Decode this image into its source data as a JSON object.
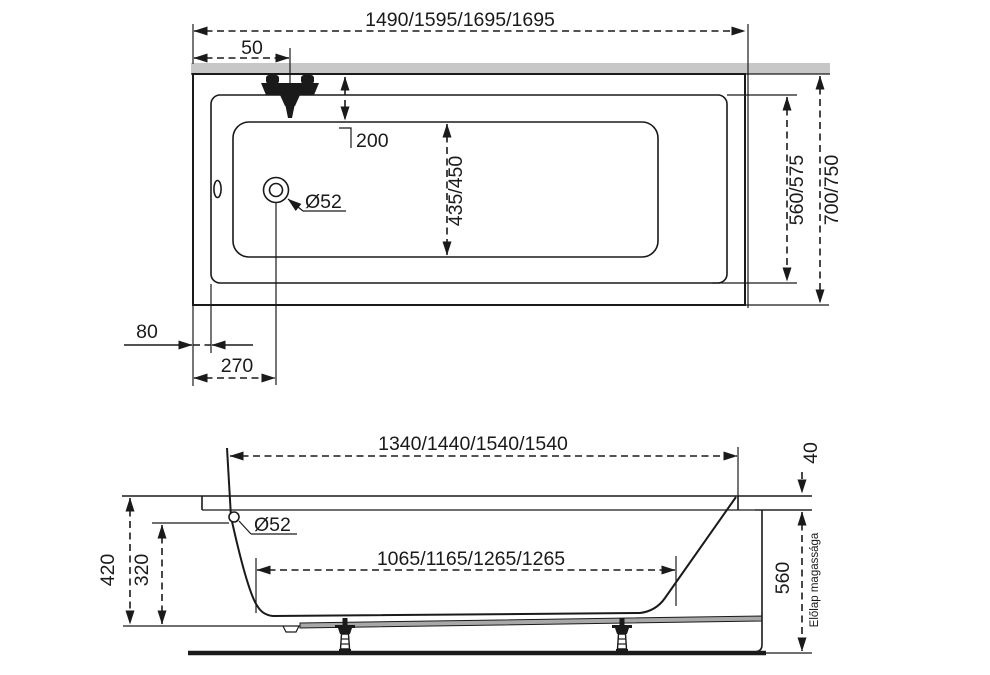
{
  "colors": {
    "line": "#1a1a1a",
    "wall_strip": "#c7c7c7",
    "board": "#a8a8a8",
    "bg": "#ffffff"
  },
  "top_view": {
    "dim_overall_length": "1490/1595/1695/1695",
    "dim_faucet_offset": "50",
    "dim_basin_inset": "200",
    "dim_basin_width": "435/450",
    "dim_drain_diameter": "Ø52",
    "dim_rim_inner_width": "560/575",
    "dim_overall_width": "700/750",
    "dim_rim_edge": "80",
    "dim_drain_offset": "270"
  },
  "side_view": {
    "dim_inner_length_top": "1340/1440/1540/1540",
    "dim_inner_length_bottom": "1065/1165/1265/1265",
    "dim_outer_height": "420",
    "dim_inner_depth": "320",
    "dim_rim_height": "40",
    "dim_panel_height": "560",
    "dim_drain_diameter": "Ø52",
    "label_panel_height": "Előlap magassága"
  }
}
